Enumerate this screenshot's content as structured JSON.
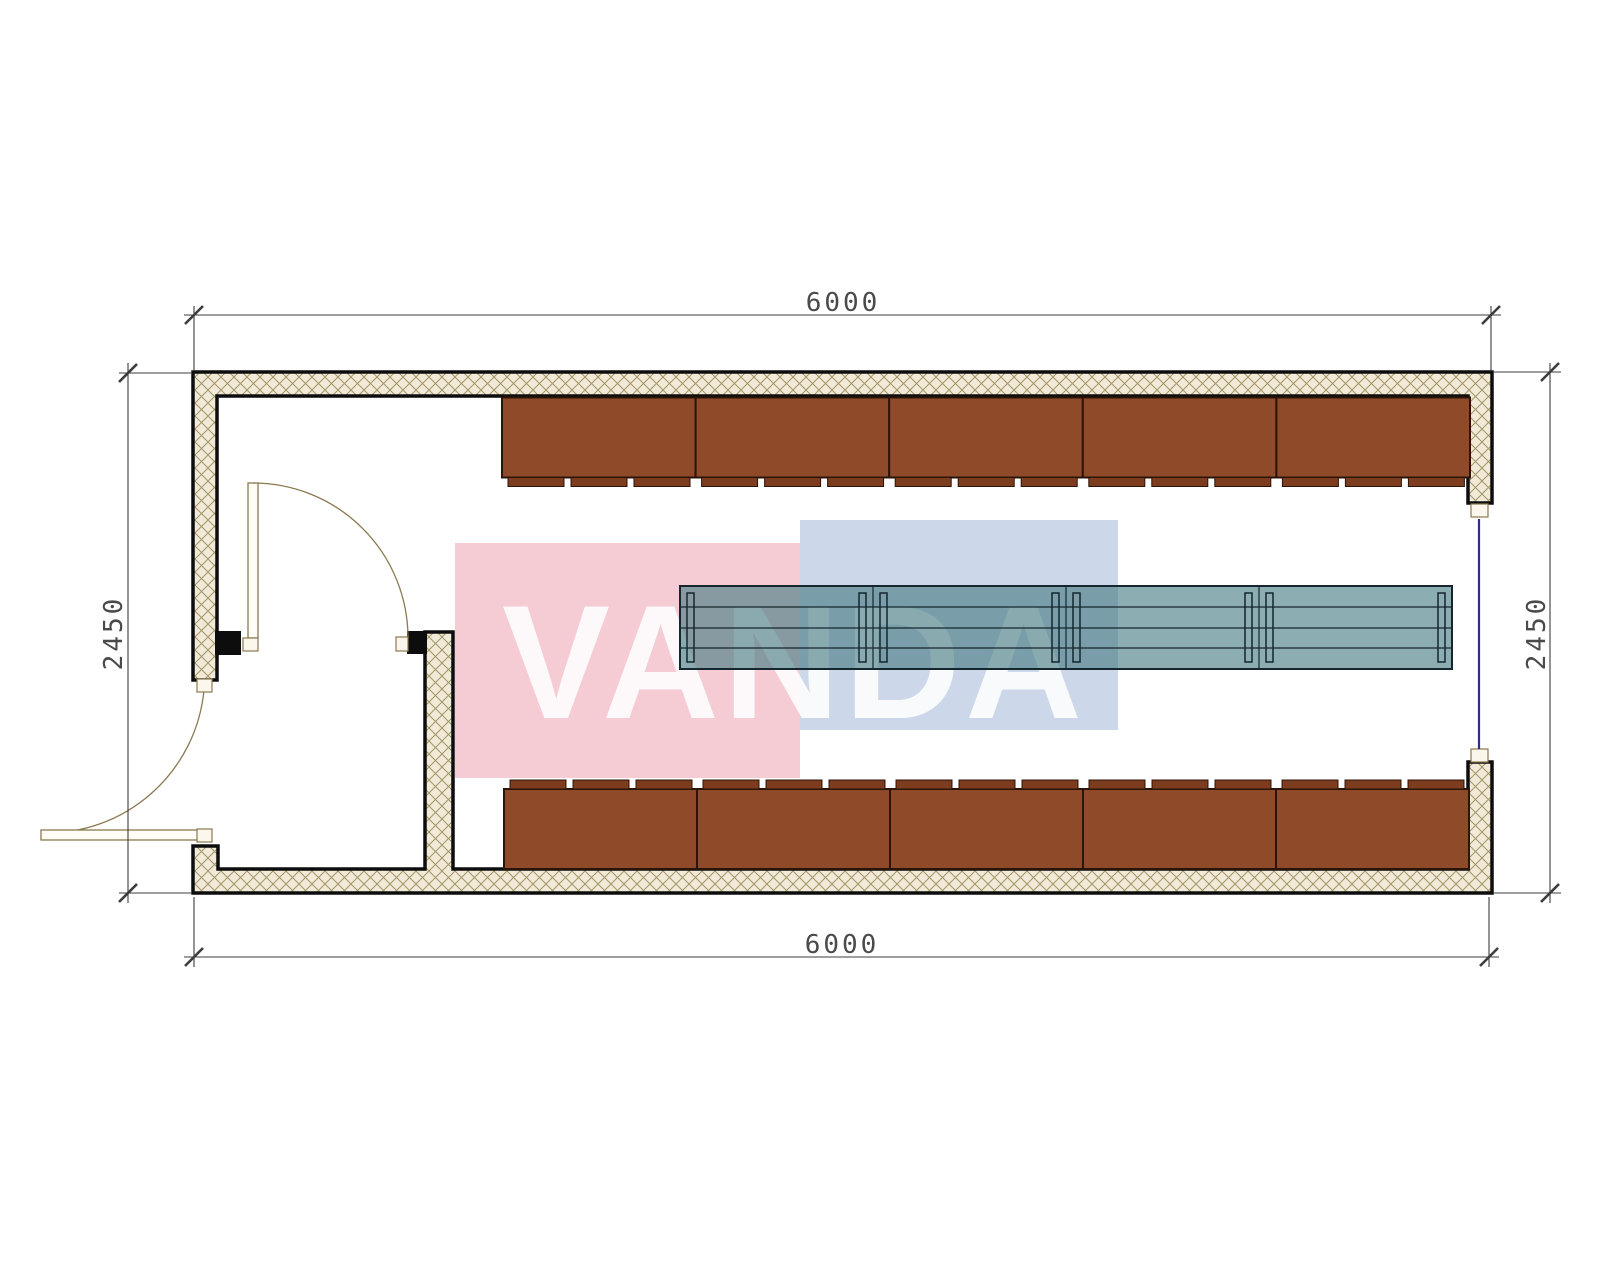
{
  "drawing": {
    "type": "container-cabin-floor-plan",
    "dimensions": {
      "top": "6000",
      "bottom": "6000",
      "left": "2450",
      "right": "2450"
    },
    "watermark": {
      "text": "VANDA"
    },
    "furniture": {
      "wardrobe_top_units": 5,
      "wardrobe_bottom_units": 5,
      "wardrobe_tabs_per_unit": 3,
      "table_segments": 4
    },
    "colors": {
      "wall_outline": "#0d0d0d",
      "hatch_bg": "#f1ead8",
      "hatch_line": "#a39566",
      "cabinet": "#8f4a2a",
      "cabinet_dark": "#7d3c1e",
      "cabinet_border": "#2b1508",
      "table_fill": "#457b81",
      "table_border": "#15262e",
      "door_line": "#8a7950",
      "door_fill": "#fffdf6",
      "jamb_fill": "#fcf7ec",
      "opening_line": "#2f2f7d",
      "dim_line": "#3d3d3d",
      "dim_text": "#4a4a4a",
      "watermark_pink": "#f5ccd4",
      "watermark_blue": "#ccd8e9",
      "watermark_text": "#ffffff"
    }
  }
}
